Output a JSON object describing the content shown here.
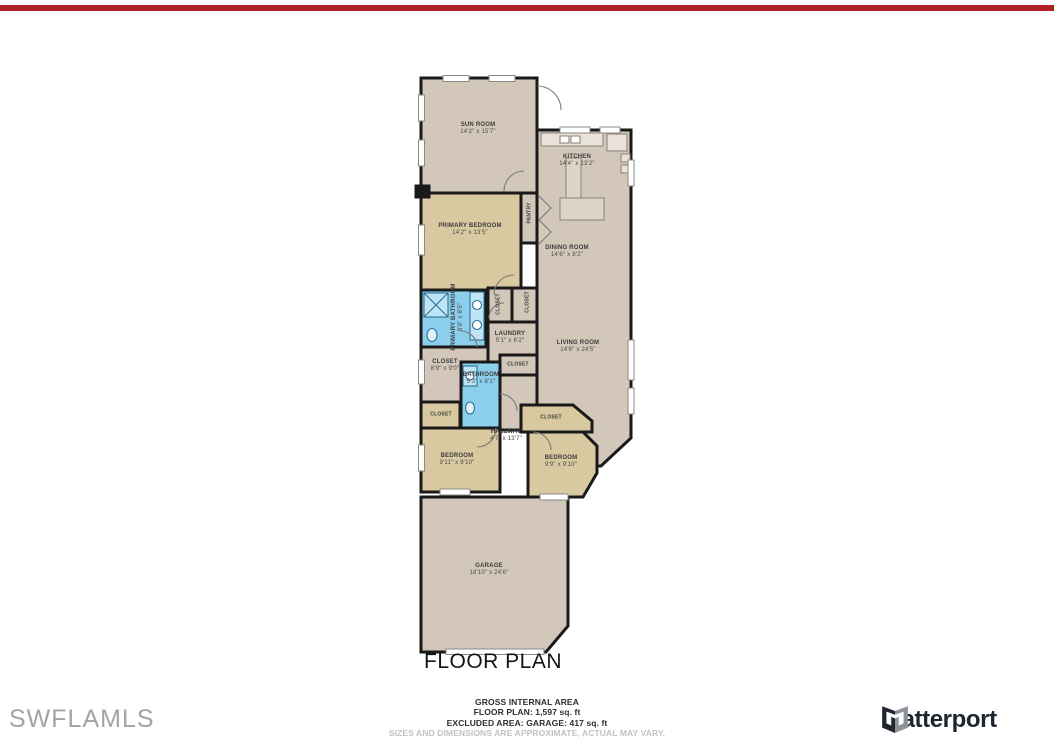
{
  "title": "FLOOR PLAN",
  "watermark": "SWFLAMLS",
  "brand": {
    "name": "Matterport",
    "logo_icon": "matterport-folded-m-icon"
  },
  "footer": {
    "line1": "GROSS INTERNAL AREA",
    "line2": "FLOOR PLAN: 1,597 sq. ft",
    "line3": "EXCLUDED AREA: GARAGE: 417 sq. ft",
    "disclaimer": "SIZES AND DIMENSIONS ARE APPROXIMATE, ACTUAL MAY VARY."
  },
  "colors": {
    "bar": "#b01f24",
    "floor": "#d3c7ba",
    "accent": "#d9c9a0",
    "bath": "#8ccfec",
    "wall": "#1a1a1a",
    "brand": "#1c2630"
  },
  "rooms": {
    "sunroom": {
      "name": "SUN ROOM",
      "dims": "14'2\" x 15'7\""
    },
    "kitchen": {
      "name": "KITCHEN",
      "dims": "14'4\" x 13'2\""
    },
    "primary_bedroom": {
      "name": "PRIMARY BEDROOM",
      "dims": "14'2\" x 13'5\""
    },
    "pantry": {
      "name": "PANTRY"
    },
    "dining": {
      "name": "DINING ROOM",
      "dims": "14'6\" x 8'2\""
    },
    "primary_bath": {
      "name": "PRIMARY BATHROOM",
      "dims": "8'9\" x 8'5\""
    },
    "closet_a": {
      "name": "CLOSET"
    },
    "closet_b": {
      "name": "CLOSET"
    },
    "laundry": {
      "name": "LAUNDRY",
      "dims": "5'1\" x 6'2\""
    },
    "living": {
      "name": "LIVING ROOM",
      "dims": "14'6\" x 24'5\""
    },
    "closet_main": {
      "name": "CLOSET",
      "dims": "8'9\" x 9'0\""
    },
    "closet_hall": {
      "name": "CLOSET"
    },
    "bathroom": {
      "name": "BATHROOM",
      "dims": "5'3\" x 8'1\""
    },
    "closet_left": {
      "name": "CLOSET"
    },
    "closet_right": {
      "name": "CLOSET"
    },
    "hallway": {
      "name": "HALLWAY",
      "dims": "4'7\" x 13'7\""
    },
    "bedroom_left": {
      "name": "BEDROOM",
      "dims": "9'11\" x 9'10\""
    },
    "bedroom_right": {
      "name": "BEDROOM",
      "dims": "9'9\" x 9'10\""
    },
    "garage": {
      "name": "GARAGE",
      "dims": "18'10\" x 24'6\""
    }
  }
}
